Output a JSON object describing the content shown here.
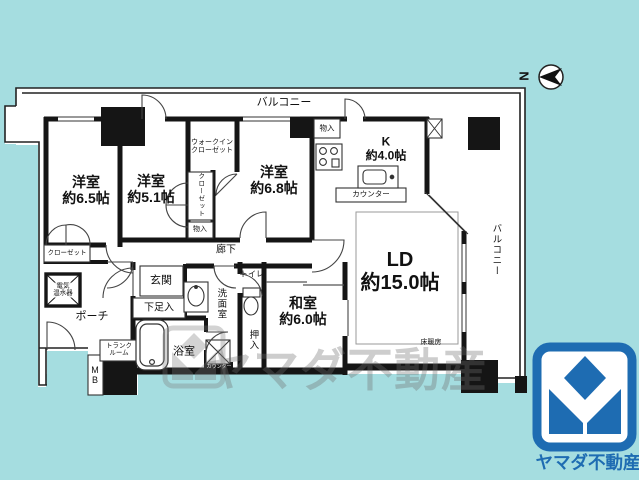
{
  "background": "#a5dde0",
  "compass": {
    "label": "N"
  },
  "watermark": {
    "text": "ヤマダ不動産"
  },
  "brand": {
    "logo_text": "ヤマダ不動産",
    "blue": "#1e6cb2"
  },
  "plan": {
    "labels": [
      {
        "name": "label-balcony-top",
        "text": "バルコニー",
        "x": 284,
        "y": 103,
        "fs": 11
      },
      {
        "name": "label-western-room-6-5",
        "text": "洋室\n約6.5帖",
        "x": 86,
        "y": 191,
        "fs": 14,
        "b": 1
      },
      {
        "name": "label-western-room-5-1",
        "text": "洋室\n約5.1帖",
        "x": 151,
        "y": 190,
        "fs": 14,
        "b": 1
      },
      {
        "name": "label-walkin-closet",
        "text": "ウォークイン\nクローゼット",
        "x": 212,
        "y": 147,
        "fs": 7
      },
      {
        "name": "label-western-room-6-8",
        "text": "洋室\n約6.8帖",
        "x": 274,
        "y": 181,
        "fs": 14,
        "b": 1
      },
      {
        "name": "label-closet-strip",
        "text": "クローゼット",
        "x": 200,
        "y": 195,
        "fs": 6.5,
        "v": 1
      },
      {
        "name": "label-storage-strip",
        "text": "物入",
        "x": 200,
        "y": 230,
        "fs": 7
      },
      {
        "name": "label-storage-kitchen",
        "text": "物入",
        "x": 327,
        "y": 129,
        "fs": 7.5
      },
      {
        "name": "label-kitchen",
        "text": "K\n約4.0帖",
        "x": 386,
        "y": 149,
        "fs": 12,
        "b": 1
      },
      {
        "name": "label-counter",
        "text": "カウンター",
        "x": 371,
        "y": 195,
        "fs": 7.5
      },
      {
        "name": "label-hallway",
        "text": "廊下",
        "x": 226,
        "y": 250,
        "fs": 10
      },
      {
        "name": "label-genkan",
        "text": "玄関",
        "x": 161,
        "y": 281,
        "fs": 11
      },
      {
        "name": "label-shoe-cabinet",
        "text": "下足入",
        "x": 159,
        "y": 308,
        "fs": 10
      },
      {
        "name": "label-porch",
        "text": "ポーチ",
        "x": 92,
        "y": 317,
        "fs": 11
      },
      {
        "name": "label-water-heater",
        "text": "電気\n温水器",
        "x": 63,
        "y": 290,
        "fs": 6.5,
        "bg": 1
      },
      {
        "name": "label-closet-bottom-left",
        "text": "クローゼット",
        "x": 67,
        "y": 253,
        "fs": 6.5
      },
      {
        "name": "label-trunk-room",
        "text": "トランク\nルーム",
        "x": 119,
        "y": 350,
        "fs": 6.5,
        "bg": 1
      },
      {
        "name": "label-meter-box",
        "text": "M\nB",
        "x": 95,
        "y": 375,
        "fs": 9
      },
      {
        "name": "label-bathroom",
        "text": "浴室",
        "x": 184,
        "y": 352,
        "fs": 11
      },
      {
        "name": "label-washroom",
        "text": "洗面室",
        "x": 220,
        "y": 304,
        "fs": 9.5,
        "v": 1
      },
      {
        "name": "label-toilet",
        "text": "トイレ",
        "x": 252,
        "y": 274,
        "fs": 8
      },
      {
        "name": "label-oshiire",
        "text": "押入",
        "x": 252,
        "y": 340,
        "fs": 9.5,
        "v": 1
      },
      {
        "name": "label-laundry-counter",
        "text": "カウンター",
        "x": 219,
        "y": 368,
        "fs": 5,
        "c": "#ffffff"
      },
      {
        "name": "label-japanese-room",
        "text": "和室\n約6.0帖",
        "x": 303,
        "y": 312,
        "fs": 14,
        "b": 1
      },
      {
        "name": "label-living-dining",
        "text": "LD\n約15.0帖",
        "x": 400,
        "y": 272,
        "fs": 20,
        "b": 1
      },
      {
        "name": "label-floor-heating",
        "text": "床暖房",
        "x": 431,
        "y": 343,
        "fs": 7
      },
      {
        "name": "label-balcony-right",
        "text": "バルコニー",
        "x": 495,
        "y": 250,
        "fs": 9.5,
        "v": 1
      }
    ]
  }
}
